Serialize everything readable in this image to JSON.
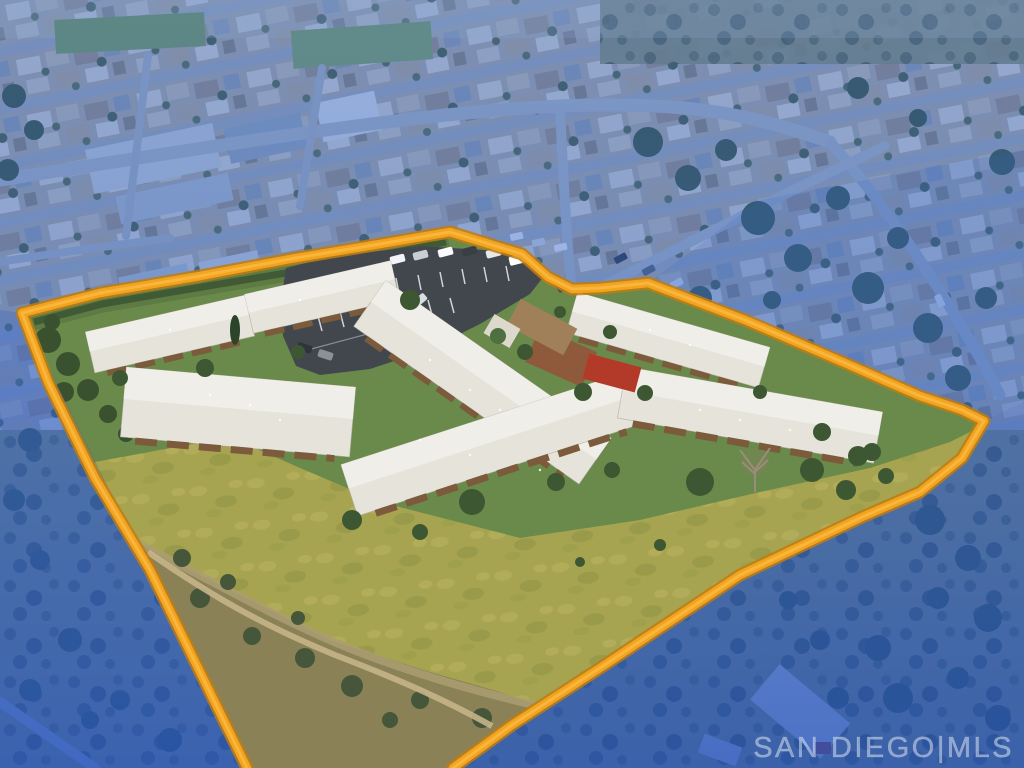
{
  "meta": {
    "kind": "aerial-drone-real-estate-photo",
    "subject": "condominium complex parcel outlined in orange; surrounding neighborhood and canyon tinted blue",
    "width": 1024,
    "height": 768
  },
  "watermark": {
    "text": "SAN DIEGO|MLS"
  },
  "scene": {
    "boundary_color": "#f2a41e",
    "boundary_glow": "#c07c12",
    "boundary_highlight": "#ffc152",
    "outside_tint": "#2e63cc",
    "lawn": "#6a8a4b",
    "meadow": "#a7a451",
    "brush": "#8a8157",
    "trail": "#c6b48a",
    "asphalt": "#42474d",
    "driveway": "#474c52",
    "roof_light": "#e5e3da",
    "roof_lit": "#efeee8",
    "porch_brown": "#7b5b3b",
    "roof_red": "#b33a28",
    "roof_terracotta": "#8f5a3c",
    "roof_tan": "#a08058",
    "neighborhood_base": "#b3ada0",
    "road": "#b2b9bf",
    "canyon_tree": "#3e5434",
    "watermark_color": "#e3eaf2"
  }
}
